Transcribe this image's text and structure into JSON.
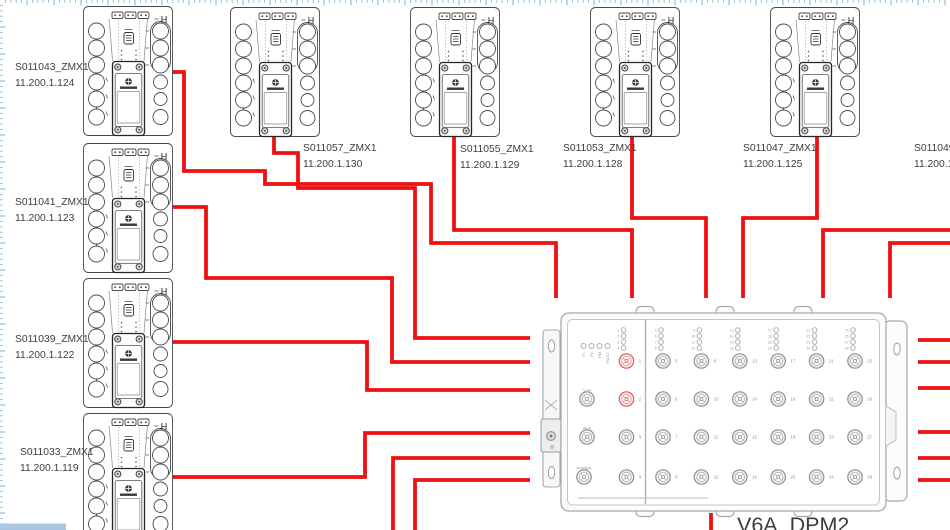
{
  "app": {
    "canvas_bg": "#ffffff",
    "wire_color": "#ee1111",
    "ruler": {
      "tick_color": "#8fbfe0",
      "major_tick_color": "#6fa8d4"
    },
    "scrollbar_color": "#a9c7e5"
  },
  "zmx": {
    "corner_mark": "H"
  },
  "devices": [
    {
      "name": "S011043_ZMX1",
      "ip": "11.200.1.124"
    },
    {
      "name": "S011041_ZMX1",
      "ip": "11.200.1.123"
    },
    {
      "name": "S011039_ZMX1",
      "ip": "11.200.1.122"
    },
    {
      "name": "S011033_ZMX1",
      "ip": "11.200.1.119"
    },
    {
      "name": "S011057_ZMX1",
      "ip": "11.200.1.130"
    },
    {
      "name": "S011055_ZMX1",
      "ip": "11.200.1.129"
    },
    {
      "name": "S011053_ZMX1",
      "ip": "11.200.1.128"
    },
    {
      "name": "S011047_ZMX1",
      "ip": "11.200.1.125"
    },
    {
      "name": "S011049",
      "ip": "11.200.1"
    }
  ],
  "dpm": {
    "name": "V6A_DPM2",
    "status_leds": [
      "P1",
      "P2",
      "RM",
      "FAULT"
    ],
    "side_ports": [
      "V.24",
      "ACA",
      "POWER"
    ],
    "port_count": 28,
    "ports_per_column": 4,
    "highlighted_ports": [
      1,
      2
    ]
  }
}
